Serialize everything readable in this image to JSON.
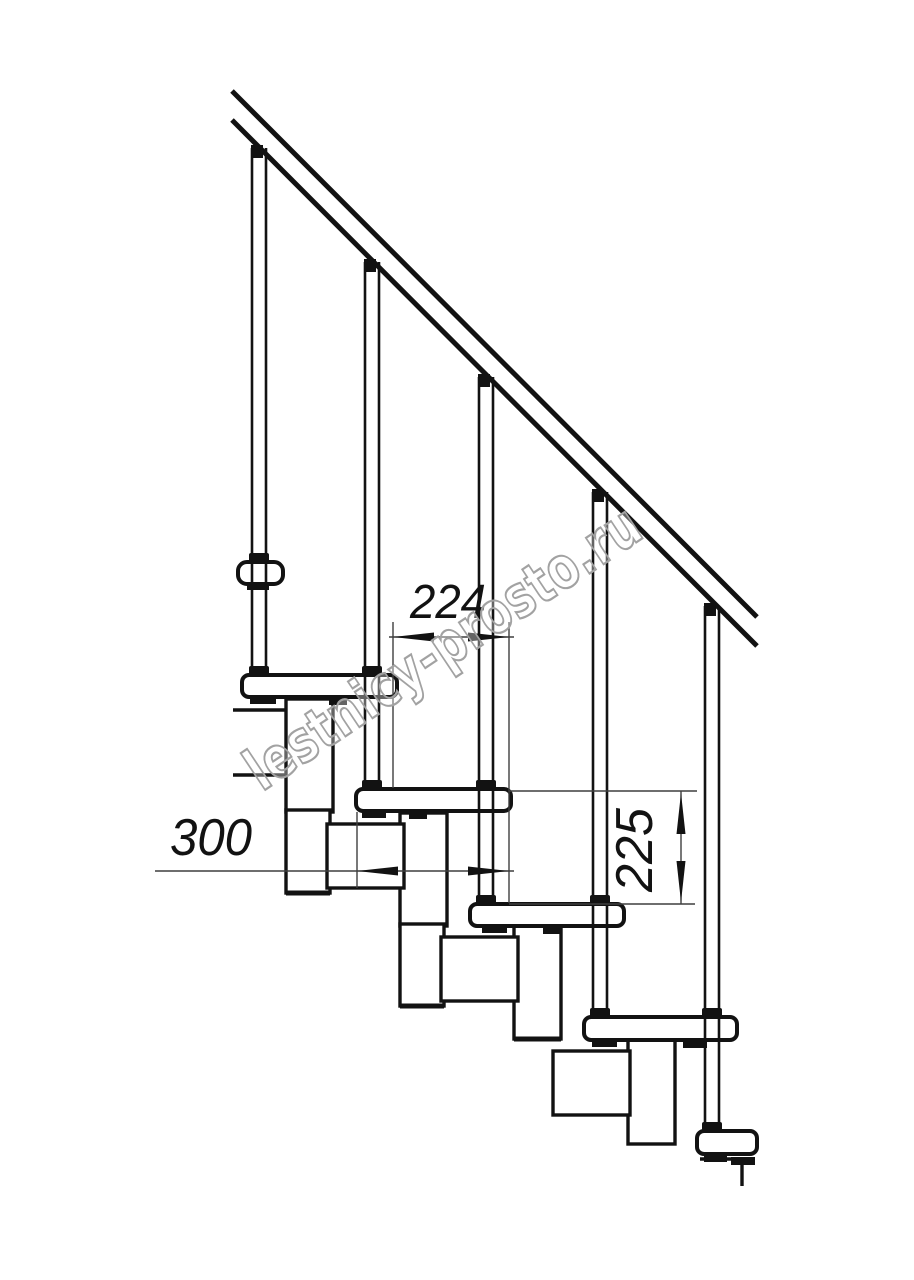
{
  "page": {
    "background": "#ffffff",
    "width": 914,
    "height": 1280
  },
  "watermark": {
    "text": "lestnicy-prosto.ru",
    "color": "#a2a2a2",
    "rotation_deg": -33.7
  },
  "dimensions": {
    "step_run": {
      "value": "224"
    },
    "tread_depth": {
      "value": "300"
    },
    "step_height": {
      "value": "225"
    }
  },
  "drawing": {
    "subject": "modular staircase side elevation",
    "line_color": "#121212",
    "dim_line_color": "#3f3f3f",
    "baluster_count": 5,
    "tread_count": 6,
    "module_box_count": 4,
    "handrail_line_count": 2
  }
}
